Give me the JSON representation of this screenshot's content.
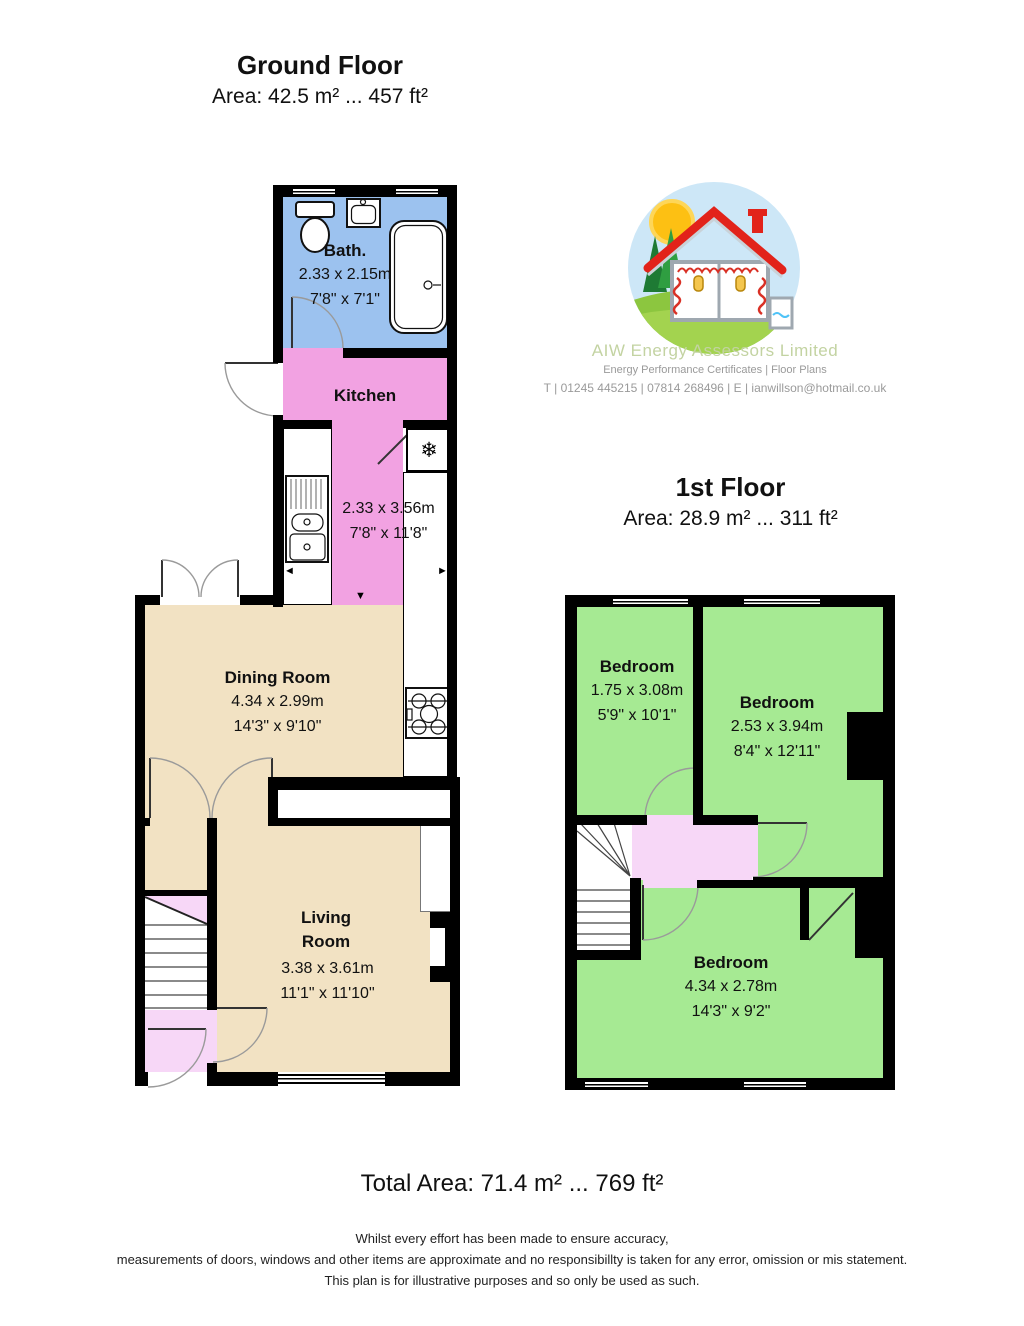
{
  "ground_floor": {
    "title": "Ground Floor",
    "area": "Area: 42.5 m² ... 457 ft²"
  },
  "first_floor": {
    "title": "1st Floor",
    "area": "Area: 28.9 m² ... 311 ft²"
  },
  "rooms": {
    "bath": {
      "name": "Bath.",
      "m": "2.33 x 2.15m",
      "ft": "7'8\" x 7'1\""
    },
    "kitchen": {
      "name": "Kitchen",
      "m": "2.33 x 3.56m",
      "ft": "7'8\" x 11'8\""
    },
    "dining": {
      "name": "Dining Room",
      "m": "4.34 x 2.99m",
      "ft": "14'3\" x 9'10\""
    },
    "living": {
      "name": "Living Room",
      "m": "3.38 x 3.61m",
      "ft": "11'1\" x 11'10\""
    },
    "bedroom1": {
      "name": "Bedroom",
      "m": "1.75 x 3.08m",
      "ft": "5'9\" x 10'1\""
    },
    "bedroom2": {
      "name": "Bedroom",
      "m": "2.53 x 3.94m",
      "ft": "8'4\" x 12'11\""
    },
    "bedroom3": {
      "name": "Bedroom",
      "m": "4.34 x 2.78m",
      "ft": "14'3\" x 9'2\""
    }
  },
  "logo": {
    "company": "AIW Energy Assessors Limited",
    "services": "Energy Performance Certificates | Floor Plans",
    "contact": "T | 01245 445215 | 07814 268496 | E | ianwillson@hotmail.co.uk"
  },
  "totals": {
    "total_area": "Total Area: 71.4 m² ... 769 ft²"
  },
  "disclaimer": [
    "Whilst every effort has been made to ensure accuracy,",
    "measurements of doors, windows and other items are approximate and no responsibillty is taken for any error, omission or mis statement.",
    "This plan is for illustrative purposes and so only be used as such."
  ],
  "icons": {
    "fridge_snowflake": "❄",
    "arrow_up": "▲",
    "arrow_down": "▼",
    "arrow_left": "◄",
    "arrow_right": "►"
  },
  "colors": {
    "bath_blue": "#9cc2ef",
    "kitchen_pink": "#f2a2e2",
    "hall_pink": "#f7d7f7",
    "room_tan": "#f2e2c3",
    "bedroom_green": "#a6ea93",
    "wall_black": "#000000",
    "logo_green": "#c3d3a2",
    "muted_gray": "#9a9a9a"
  }
}
